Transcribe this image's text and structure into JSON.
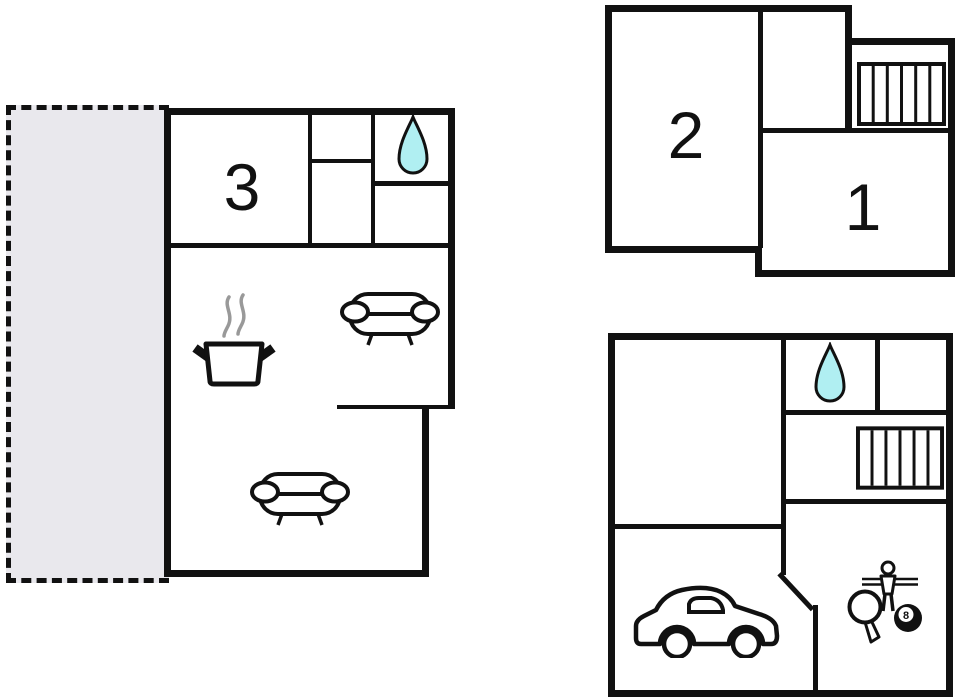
{
  "colors": {
    "wall": "#111111",
    "background": "#ffffff",
    "terrace_fill": "#e9e8ed",
    "water_drop_fill": "#b0eff2",
    "steam": "#999999"
  },
  "plans": {
    "ground_floor": {
      "rooms": [
        {
          "label": "3"
        }
      ],
      "icons": [
        "water-drop",
        "cooking-pot-with-steam",
        "sofa",
        "sofa"
      ],
      "features": [
        "dashed-terrace-outline"
      ]
    },
    "upper_floor": {
      "rooms": [
        {
          "label": "2"
        },
        {
          "label": "1"
        }
      ],
      "icons": [
        "stairs"
      ]
    },
    "basement": {
      "rooms": [],
      "icons": [
        "water-drop",
        "stairs",
        "car",
        "table-tennis-paddle",
        "table-football-player",
        "billiard-ball"
      ],
      "billiard_ball_label": "8"
    }
  }
}
